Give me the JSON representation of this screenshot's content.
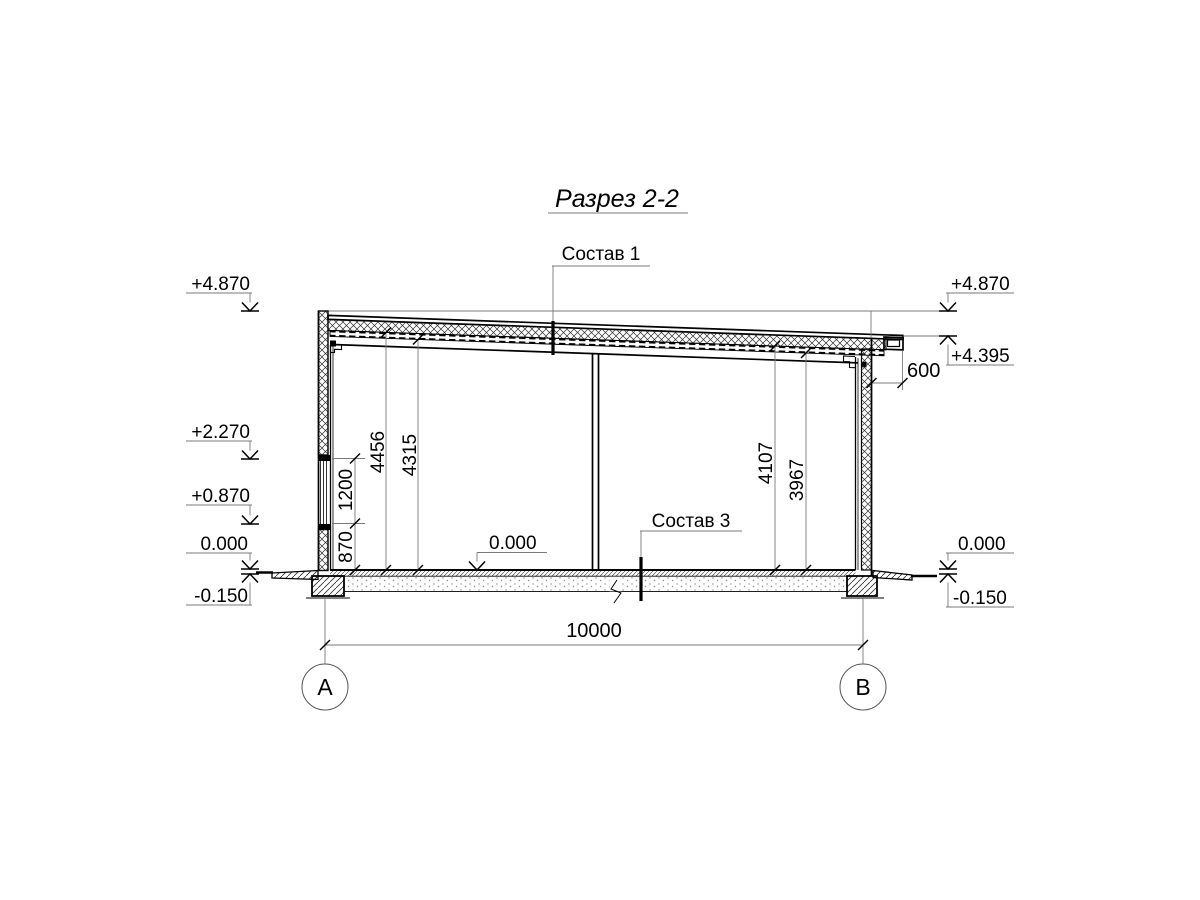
{
  "title": "Разрез 2-2",
  "annotations": {
    "composition_roof": "Состав 1",
    "composition_floor": "Состав 3"
  },
  "elevations": {
    "left": [
      "+4.870",
      "+2.270",
      "+0.870",
      "0.000",
      "-0.150"
    ],
    "right": [
      "+4.870",
      "+4.395",
      "0.000",
      "-0.150"
    ],
    "floor_interior": "0.000"
  },
  "dimensions": {
    "overall_width": "10000",
    "roof_overhang": "600",
    "left_chain": [
      "870",
      "1200"
    ],
    "left_heights": [
      "4456",
      "4315"
    ],
    "right_heights": [
      "4107",
      "3967"
    ]
  },
  "axes": {
    "left": "А",
    "right": "В"
  }
}
